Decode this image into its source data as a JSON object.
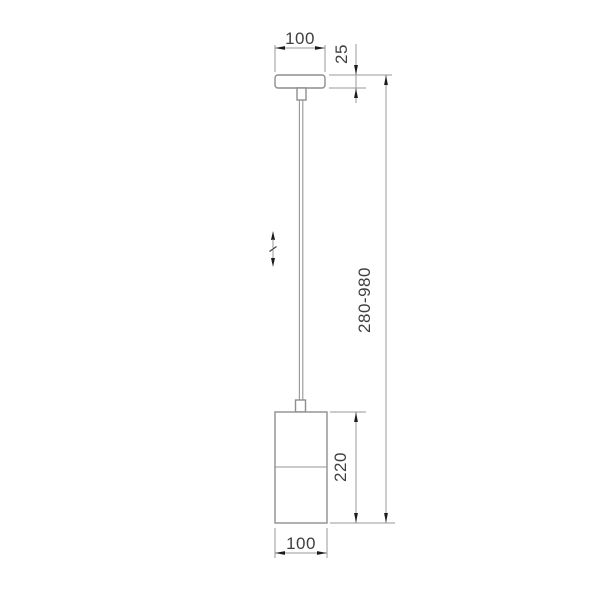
{
  "drawing": {
    "kind": "technical-dimension-drawing",
    "object": "pendant-lamp",
    "labels": {
      "canopy_width": "100",
      "canopy_height": "25",
      "overall_height_range": "280-980",
      "shade_height": "220",
      "shade_width": "100"
    },
    "symbols": {
      "height_adjustment": "double-headed-vertical-arrow"
    },
    "colors": {
      "background": "#ffffff",
      "outline": "#8e8e8e",
      "dimension_line": "#9a9a9a",
      "arrowhead": "#1c1c1c",
      "text": "#3f3f3f"
    }
  }
}
